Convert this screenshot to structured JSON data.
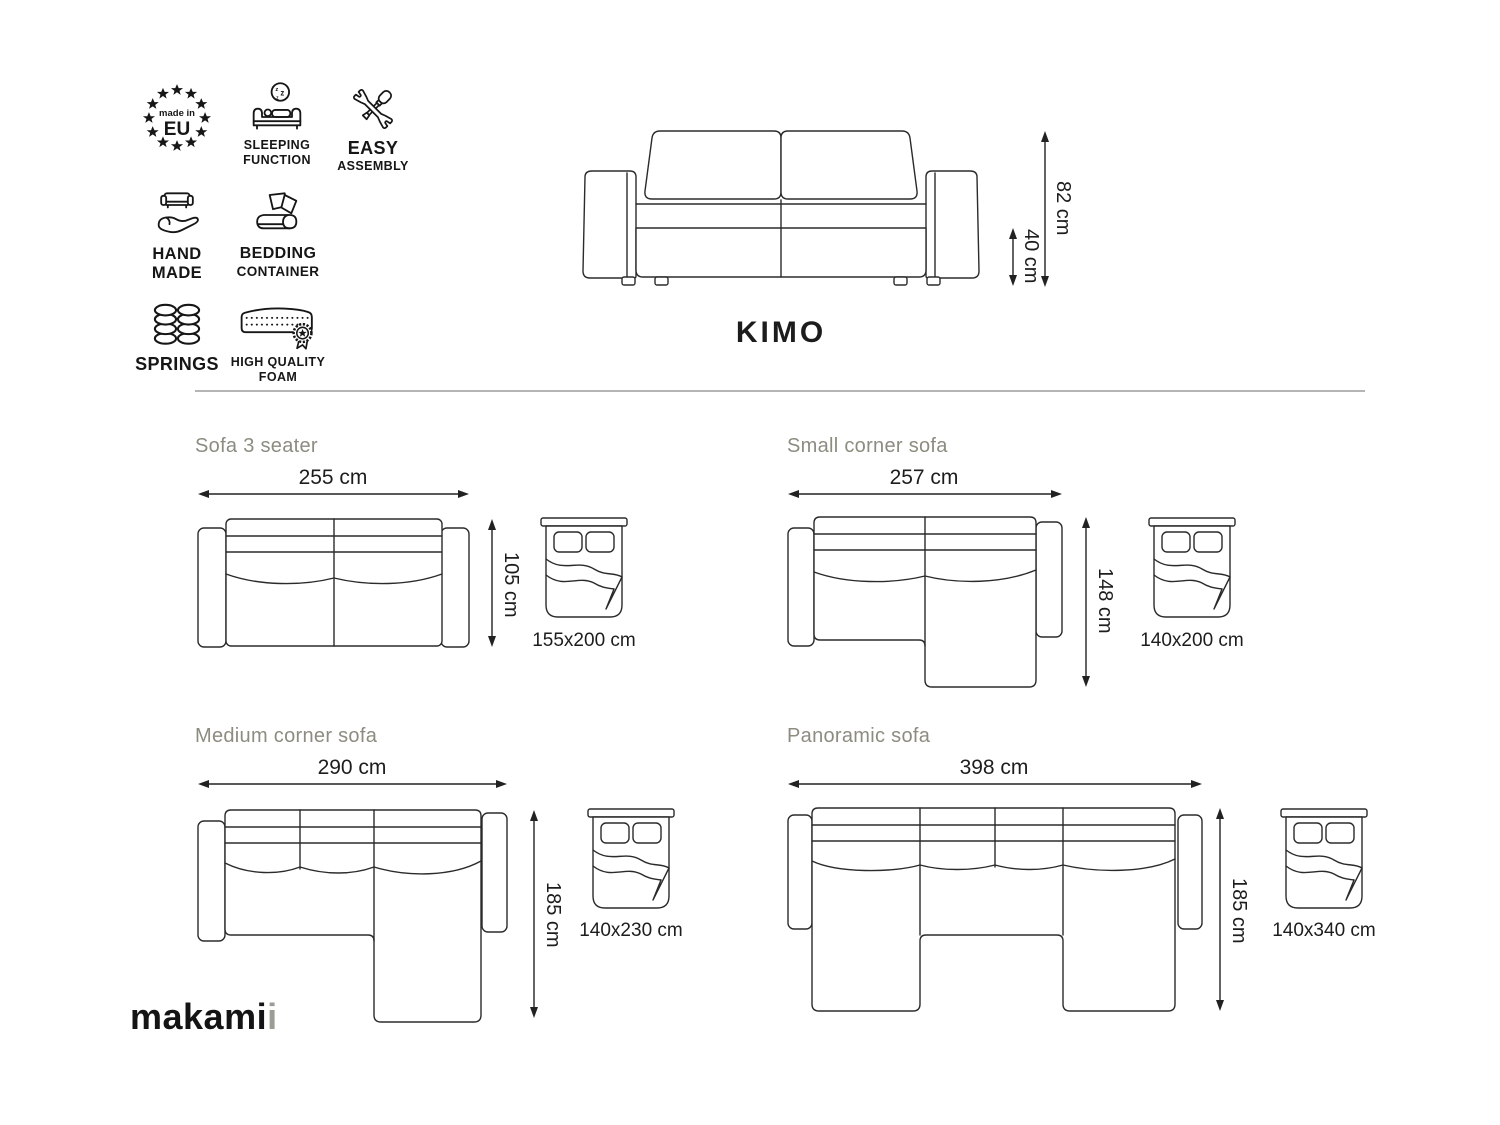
{
  "product": {
    "title": "KIMO"
  },
  "brand": {
    "logo_black": "makami",
    "logo_gray": "i"
  },
  "features": {
    "made_in_eu": {
      "small": "made in",
      "big": "EU"
    },
    "sleeping_function": {
      "line1": "SLEEPING",
      "line2": "FUNCTION"
    },
    "easy_assembly": {
      "line1": "EASY",
      "line2": "ASSEMBLY"
    },
    "hand_made": {
      "line1": "HAND",
      "line2": "MADE"
    },
    "bedding_container": {
      "line1": "BEDDING",
      "line2": "CONTAINER"
    },
    "springs": {
      "label": "SPRINGS"
    },
    "high_quality_foam": {
      "line1": "HIGH QUALITY",
      "line2": "FOAM"
    }
  },
  "front_view": {
    "total_height": "82 cm",
    "seat_height": "40 cm"
  },
  "variants": [
    {
      "name": "Sofa 3 seater",
      "width": "255 cm",
      "depth": "105 cm",
      "bed_size": "155x200 cm"
    },
    {
      "name": "Small corner sofa",
      "width": "257 cm",
      "depth": "148 cm",
      "bed_size": "140x200 cm"
    },
    {
      "name": "Medium corner sofa",
      "width": "290 cm",
      "depth": "185 cm",
      "bed_size": "140x230 cm"
    },
    {
      "name": "Panoramic sofa",
      "width": "398 cm",
      "depth": "185 cm",
      "bed_size": "140x340 cm"
    }
  ],
  "colors": {
    "background": "#ffffff",
    "line_art": "#2b2b2b",
    "text": "#1d1d1d",
    "section_title": "#8c8c80",
    "divider": "#b5b5b5",
    "logo_gray": "#9c9c94"
  }
}
